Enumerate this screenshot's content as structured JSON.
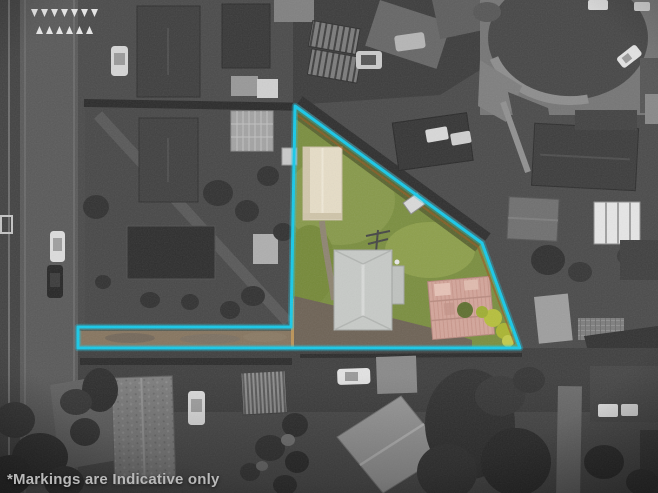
{
  "photo": {
    "type": "aerial-property-photograph",
    "disclaimer": "*Markings are Indicative only"
  },
  "markings": {
    "boundary_color": "#16C9E9",
    "boundary_style": "solid cyan outline around highlighted lot with access strip",
    "surroundings_treatment": "grayscale",
    "highlighted_area_treatment": "full color"
  },
  "palette": {
    "lawn_green": "#7A8E3F",
    "shed_cream": "#E6DDC7",
    "house_roof_gray": "#C7CAC7",
    "cottage_roof_pink": "#D3A59A",
    "driveway_tan": "#BB9357",
    "caption_text": "#B9B9B9",
    "background_gray": "#4A4A4A"
  }
}
